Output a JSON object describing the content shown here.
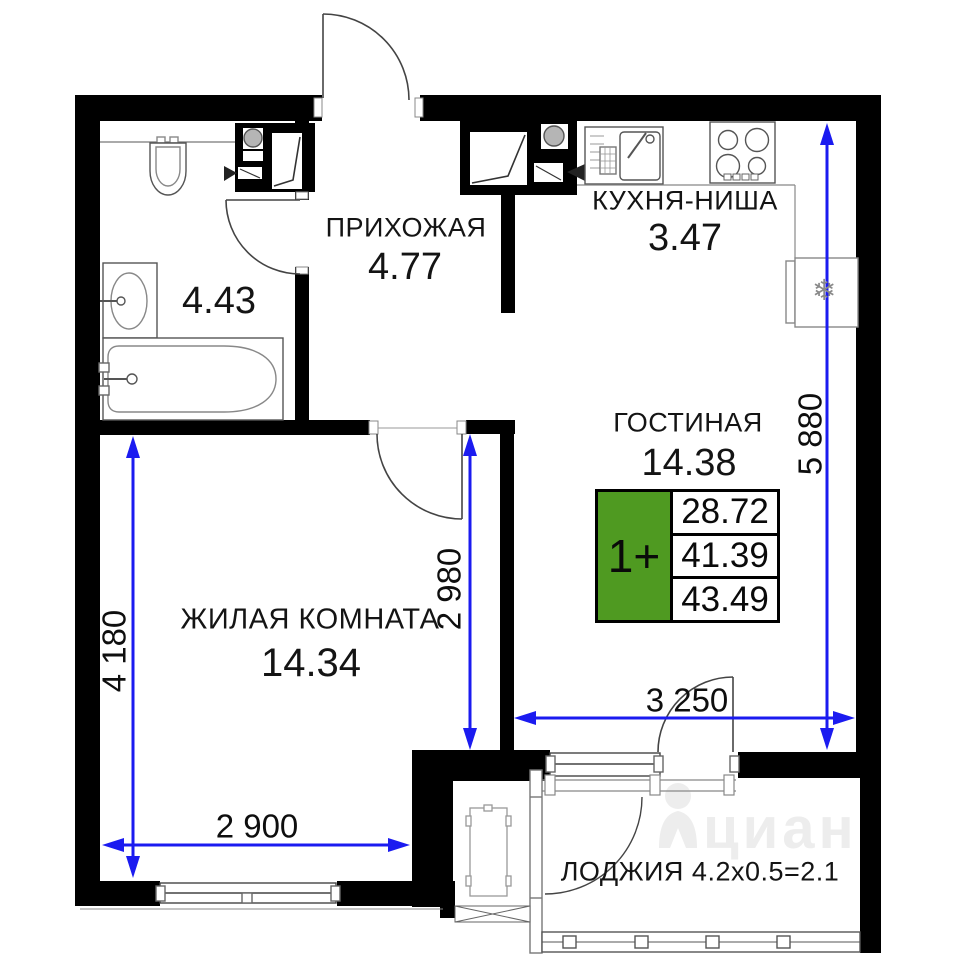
{
  "plan_title": "1-room apartment floor plan",
  "badge": {
    "rooms_label": "1+",
    "values": [
      "28.72",
      "41.39",
      "43.49"
    ],
    "green_color": "#4f9a21"
  },
  "rooms": {
    "hallway": {
      "name": "ПРИХОЖАЯ",
      "area": "4.77"
    },
    "kitchen_niche": {
      "name": "КУХНЯ-НИША",
      "area": "3.47"
    },
    "living_room": {
      "name": "ГОСТИНАЯ",
      "area": "14.38"
    },
    "bedroom": {
      "name": "ЖИЛАЯ КОМНАТА",
      "area": "14.34"
    },
    "bathroom": {
      "area": "4.43"
    },
    "loggia": {
      "label": "ЛОДЖИЯ 4.2x0.5=2.1"
    }
  },
  "dimensions": {
    "bedroom_height": "4 180",
    "bedroom_inner_height": "2 980",
    "right_side_height": "5 880",
    "bedroom_width": "2 900",
    "living_width": "3 250",
    "blue_color": "#1b1bf0"
  },
  "fixtures": {
    "fridge_snowflake": "❄"
  },
  "watermark": {
    "text": "циан"
  },
  "colors": {
    "wall": "#000000",
    "background": "#ffffff",
    "label_text": "#141414"
  }
}
